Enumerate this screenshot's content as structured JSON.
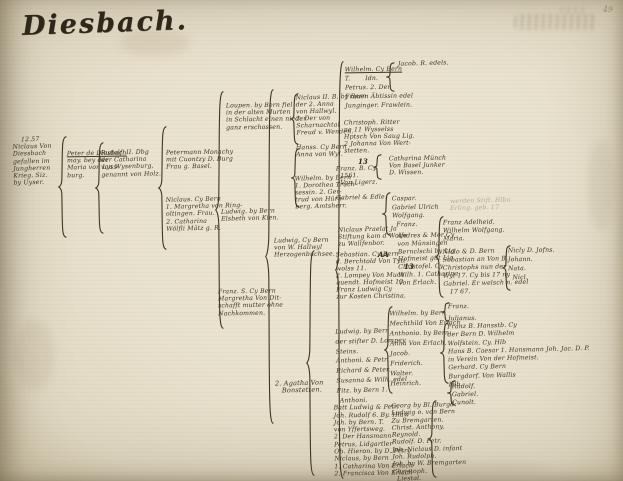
{
  "page": {
    "title": "Diesbach.",
    "page_number": "49"
  },
  "colors": {
    "paper": "#e8e1cd",
    "ink": "#3f3522",
    "faint_ink": "#8d7c5c"
  },
  "tree": {
    "blocks": [
      {
        "name": "entry-niclaus-1257",
        "x": 13,
        "y": 136,
        "w": 50,
        "lines": [
          "    12.57",
          "Niclaus Von",
          "Diessbach",
          "gefallen im",
          "Jungherren",
          "Krieg. Siz.",
          "by Uyser."
        ]
      },
      {
        "name": "entry-peter-de-diesbach",
        "x": 67,
        "y": 150,
        "w": 52,
        "ul_first": true,
        "lines": [
          "Peter de Diesbach",
          "may. bey der",
          "Maria von Lyss-",
          "burg."
        ]
      },
      {
        "name": "entry-rudolf-ii",
        "x": 101,
        "y": 149,
        "w": 64,
        "lines": [
          "Rudolf. II. Dbg",
          "der Catharina",
          "von Wysenburg,",
          "genannt von Holz."
        ]
      },
      {
        "name": "entry-petermann",
        "x": 166,
        "y": 149,
        "w": 62,
        "lines": [
          "Petermann Monachy",
          "mit Cuontzy D. Burg",
          "Frau g. Basel."
        ]
      },
      {
        "name": "entry-niclaus-bern",
        "x": 166,
        "y": 196,
        "w": 64,
        "lines": [
          "Niclaus. Cy Bern",
          "1. Margretha von Ring-",
          "oltingen. Frau.",
          "2. Catharina",
          "Wölfli Mätz g. R."
        ]
      },
      {
        "name": "entry-loupen",
        "x": 226,
        "y": 102,
        "w": 68,
        "lines": [
          "Loupen. by Bern fiel",
          "in der alten Murten",
          "in Schlacht einen nieder",
          "ganz erschossen."
        ]
      },
      {
        "name": "entry-ludwig-kien",
        "x": 221,
        "y": 208,
        "w": 58,
        "lines": [
          "Ludwig. by Bern",
          "Elsbeth von Kien."
        ]
      },
      {
        "name": "entry-franz-bern",
        "x": 218,
        "y": 288,
        "w": 60,
        "lines": [
          "Franz. S. Cy Bern",
          "Margretha Von Dit-",
          "schafft mutter ohne",
          "Nachkommen."
        ]
      },
      {
        "name": "entry-niclaus-ii",
        "x": 296,
        "y": 94,
        "w": 42,
        "lh": 7,
        "lines": [
          "Niclaus II. B. by Bern",
          "der 2. Anna",
          "von Hallwyl.",
          "2. Der von",
          "Scharnachtal",
          "Freud v. Wenden."
        ]
      },
      {
        "name": "entry-hanss",
        "x": 296,
        "y": 144,
        "w": 40,
        "lines": [
          "Hanss. Cy Bern",
          "Anna von Wyl."
        ]
      },
      {
        "name": "entry-wilhelm-bern",
        "x": 295,
        "y": 175,
        "w": 44,
        "lh": 7,
        "lines": [
          "Wilhelm. by Bern",
          "1. Dorothea Truch-",
          "sessin. 2. Ger-",
          "trud von Hürn-",
          "berg. Amtsherr."
        ]
      },
      {
        "name": "entry-ludwig-hallwyl",
        "x": 274,
        "y": 237,
        "w": 62,
        "lines": [
          "Ludwig, Cy Bern",
          "von W. Hallwyl",
          "Herzogenbuchsee."
        ]
      },
      {
        "name": "entry-agatha-bonstetten",
        "x": 275,
        "y": 380,
        "w": 54,
        "size": 6.6,
        "lines": [
          "2. Agatha Von",
          "   Bonstetten."
        ]
      },
      {
        "name": "entry-wilhelm-cy-bern",
        "x": 345,
        "y": 65,
        "w": 62,
        "lh": 9,
        "ul_first": true,
        "lines": [
          "Wilhelm. Cy Bern",
          "T.       Idn.",
          "Petrus. 2. Der",
          "Frauen Äbtissin edel",
          "Junginger. Frawlein."
        ]
      },
      {
        "name": "entry-jacob-edels",
        "x": 398,
        "y": 60,
        "w": 52,
        "lines": [
          "Jacob. R. edels."
        ]
      },
      {
        "name": "entry-christoph-ritter",
        "x": 344,
        "y": 119,
        "w": 84,
        "lh": 7,
        "lines": [
          "Christoph. Ritter",
          "ne 11 Wysselss",
          "Hptsch Von Saug Lig.",
          "2 Johanna Von Wert-",
          "stetten."
        ]
      },
      {
        "name": "entry-franz-ligerz",
        "x": 336,
        "y": 165,
        "w": 56,
        "lines": [
          "Franz. B. Cy",
          "  1561.",
          "  Von Ligerz."
        ]
      },
      {
        "name": "entry-catharina-muench",
        "x": 389,
        "y": 155,
        "w": 60,
        "lines": [
          "Catharina Münch",
          "Von Basel Junker",
          "D. Wissen."
        ]
      },
      {
        "name": "entry-gabriel-edle",
        "x": 336,
        "y": 194,
        "w": 56,
        "lines": [
          "Gabriel & Edle."
        ]
      },
      {
        "name": "entry-caspar-list",
        "x": 392,
        "y": 195,
        "w": 52,
        "lh": 8.5,
        "lines": [
          "Caspar.",
          "Gabriel Ulrich",
          "Wolfgang.",
          "  Franz."
        ]
      },
      {
        "name": "entry-niclaus-praelat",
        "x": 338,
        "y": 226,
        "w": 66,
        "lh": 7,
        "lines": [
          "Niclaus Praelat Ja",
          "Stiftung kam d Wolfe",
          "zu Wallfenbor."
        ]
      },
      {
        "name": "entry-sebastian",
        "x": 336,
        "y": 251,
        "w": 70,
        "lh": 7,
        "lines": [
          "Sebastian. Cy Bern",
          "d. Berchtold Von Tytt",
          "wolss 11.",
          "2. Lompey Von Much",
          "quendt. Hofmeist 13",
          "Franz Ludwig Cy",
          "zur Kosten Christina."
        ]
      },
      {
        "name": "entry-andres",
        "x": 398,
        "y": 232,
        "w": 62,
        "lh": 7.8,
        "lines": [
          "Andres & Mor Cy",
          "von Münsingen",
          "Bernclschi by Lig",
          "Hofmeist gilt Lig",
          "Christofel. Cy",
          "Wilh. 1. Catharina",
          "Von Erlach."
        ]
      },
      {
        "name": "entry-adelheid",
        "x": 443,
        "y": 219,
        "w": 60,
        "lh": 8,
        "lines": [
          "Franz Adelheid.",
          "Wilhelm Wolfgang.",
          "Maria."
        ]
      },
      {
        "name": "entry-niclo",
        "x": 443,
        "y": 248,
        "w": 64,
        "lh": 8,
        "lines": [
          "Niclo & D. Bern",
          "Sebastian an Von B.",
          "Christophs nun der",
          "Wyl 17. Cy bis 17 ny",
          "Gabriel. Er welsch n. edel",
          "   17 67."
        ]
      },
      {
        "name": "entry-far-right-list",
        "x": 508,
        "y": 246,
        "w": 44,
        "lh": 9,
        "lines": [
          "Nicly D. Jofns.",
          "Johann.",
          "Nata.",
          "  Nicl."
        ]
      },
      {
        "name": "note-faint",
        "x": 450,
        "y": 197,
        "w": 88,
        "faint": true,
        "lines": [
          "werden Stift. Hlbn",
          "Erling. geb. 17"
        ]
      },
      {
        "name": "entry-wilhelm-erlach",
        "x": 390,
        "y": 309,
        "w": 52,
        "lh": 10,
        "lines": [
          "Wilhelm. by Bern",
          "Mechthild Von Erlach",
          "Anthonio. by Bern",
          "Anna Von Erlach.",
          "Jacob.",
          "Friderich.",
          "Walter.",
          "Heinrich."
        ]
      },
      {
        "name": "entry-ludwig-stifter",
        "x": 336,
        "y": 327,
        "w": 52,
        "lh": 9.8,
        "lines": [
          "Ludwig. by Bern",
          "der stifter D. Lompey",
          "Steins.",
          "Anthoni. & Petr.",
          "Richard & Peter.",
          "Susanna & Wilh. edel",
          "Fitz. by Bern 1."
        ]
      },
      {
        "name": "entry-bottom-left-list",
        "x": 334,
        "y": 397,
        "w": 62,
        "lh": 7.3,
        "lines": [
          "   Anthoni.",
          "Batt Ludwig & Petr.",
          "Joh. Rudolf 6. By. Hlaw",
          "Joh. by Bern. T.",
          "von Yffertsweg.",
          "2. Der Hansmann",
          "Petrus, Lidgartler",
          "Ob. Hieron. by D. Petry",
          "Niclaus, by Bern",
          "1. Catharina Von Erlach",
          "2. Francisca Von Erlach"
        ]
      },
      {
        "name": "entry-georg-list",
        "x": 392,
        "y": 402,
        "w": 56,
        "lh": 7.3,
        "lines": [
          "Georg by Bl. Burgd.",
          "Ludwig o. von Bern",
          "Zu Bremgarten.",
          "Christ. Anthony.",
          "Reynold.",
          "Rudolf. D. Petr.",
          "Joh. Niclaus D. infant",
          "Joh. Rudolph.",
          "Joh. by W. Bremgarten",
          "Christoph.",
          "  Liestal."
        ]
      },
      {
        "name": "entry-franz-julianus",
        "x": 448,
        "y": 301,
        "w": 40,
        "lh": 12,
        "lines": [
          "Franz.",
          "Julianus."
        ]
      },
      {
        "name": "entry-franz-b",
        "x": 448,
        "y": 322,
        "w": 112,
        "lh": 8.3,
        "lines": [
          "Franz B. Hansstb. Cy",
          "der Bern D. Wilhelm",
          "Wolfstein. Cy. Hlb",
          "Hans B. Caesar 1. Hansmann Joh. Jac. D. P.",
          "in Verein Von der Hofmeist.",
          "Gerhard. Cy Bern",
          "Burgdorf. Von Wallis",
          "Hlb."
        ]
      },
      {
        "name": "entry-rudolf-list",
        "x": 452,
        "y": 383,
        "w": 40,
        "lh": 8,
        "lines": [
          "Rudolf.",
          "Gabriel.",
          "Cunolt."
        ]
      }
    ],
    "braces": [
      {
        "x": 57,
        "y": 136,
        "h": 102
      },
      {
        "x": 94,
        "y": 142,
        "h": 92
      },
      {
        "x": 157,
        "y": 126,
        "h": 124
      },
      {
        "x": 214,
        "y": 91,
        "h": 238
      },
      {
        "x": 264,
        "y": 89,
        "h": 335
      },
      {
        "x": 289,
        "y": 93,
        "h": 52
      },
      {
        "x": 290,
        "y": 148,
        "h": 60
      },
      {
        "x": 305,
        "y": 250,
        "h": 226
      },
      {
        "x": 334,
        "y": 61,
        "h": 418
      },
      {
        "x": 385,
        "y": 62,
        "h": 30
      },
      {
        "x": 372,
        "y": 154,
        "h": 26
      },
      {
        "x": 381,
        "y": 192,
        "h": 44
      },
      {
        "x": 434,
        "y": 216,
        "h": 82
      },
      {
        "x": 383,
        "y": 306,
        "h": 88
      },
      {
        "x": 440,
        "y": 302,
        "h": 20
      },
      {
        "x": 439,
        "y": 322,
        "h": 62
      },
      {
        "x": 427,
        "y": 400,
        "h": 78
      },
      {
        "x": 501,
        "y": 245,
        "h": 46
      },
      {
        "x": 446,
        "y": 380,
        "h": 26
      }
    ],
    "markers": [
      {
        "text": "13",
        "x": 358,
        "y": 157
      },
      {
        "text": "AA",
        "x": 378,
        "y": 250
      },
      {
        "text": "13",
        "x": 404,
        "y": 262
      }
    ]
  }
}
